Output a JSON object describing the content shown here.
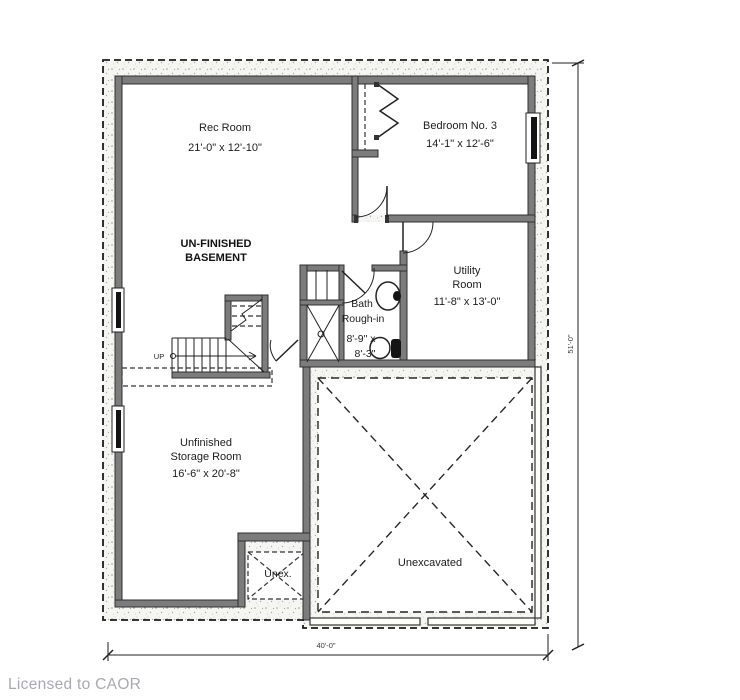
{
  "footer": {
    "license": "Licensed to CAOR"
  },
  "plan": {
    "rooms": {
      "rec": {
        "name": "Rec Room",
        "dims": "21'-0\" x 12'-10\""
      },
      "basement": {
        "line1": "UN-FINISHED",
        "line2": "BASEMENT"
      },
      "bedroom3": {
        "name": "Bedroom No. 3",
        "dims": "14'-1\" x 12'-6\""
      },
      "utility": {
        "line1": "Utility",
        "line2": "Room",
        "dims": "11'-8\" x 13'-0\""
      },
      "bath": {
        "line1": "Bath",
        "line2": "Rough-in",
        "dims1": "8'-9\" x",
        "dims2": "8'-3\""
      },
      "storage": {
        "line1": "Unfinished",
        "line2": "Storage Room",
        "dims": "16'-6\" x 20'-8\""
      },
      "unex": {
        "name": "Unex."
      },
      "unexcavated": {
        "name": "Unexcavated"
      }
    },
    "stairs": {
      "direction": "UP"
    },
    "dimensions": {
      "overall_width": "40'-0\"",
      "overall_height": "51'-0\""
    },
    "colors": {
      "wall_fill": "#7c7c7c",
      "wall_stroke": "#2f2f2f",
      "window_glass": "#141414",
      "line": "#1f1f1f",
      "speckle_dot": "#9b9b9b",
      "footer_text": "#a9a9b2"
    }
  }
}
